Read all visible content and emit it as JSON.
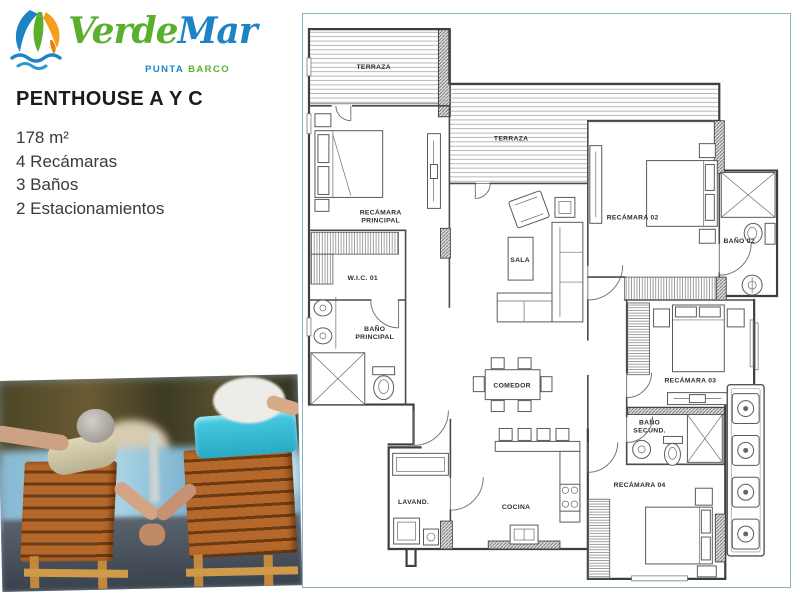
{
  "brand": {
    "name_green": "Verde",
    "name_blue": "Mar",
    "tagline_blue": "PUNTA",
    "tagline_green": "BARCO",
    "color_green": "#5ab02c",
    "color_blue": "#1d83c5",
    "color_orange": "#f59d1e"
  },
  "title": "PENTHOUSE A Y C",
  "specs": [
    "178 m²",
    "4 Recámaras",
    "3 Baños",
    "2 Estacionamientos"
  ],
  "floorplan": {
    "labels": {
      "terraza_1": "TERRAZA",
      "terraza_2": "TERRAZA",
      "recamara_principal_1": "RECÁMARA",
      "recamara_principal_2": "PRINCIPAL",
      "wic_01": "W.I.C. 01",
      "bano_principal_1": "BAÑO",
      "bano_principal_2": "PRINCIPAL",
      "sala": "SALA",
      "comedor": "COMEDOR",
      "cocina": "COCINA",
      "lavanderia": "LAVAND.",
      "recamara_02": "RECÁMARA 02",
      "bano_02": "BAÑO 02",
      "recamara_03": "RECÁMARA 03",
      "bano_secundario_1": "BAÑO",
      "bano_secundario_2": "SECUND.",
      "recamara_04": "RECÁMARA 04"
    }
  }
}
